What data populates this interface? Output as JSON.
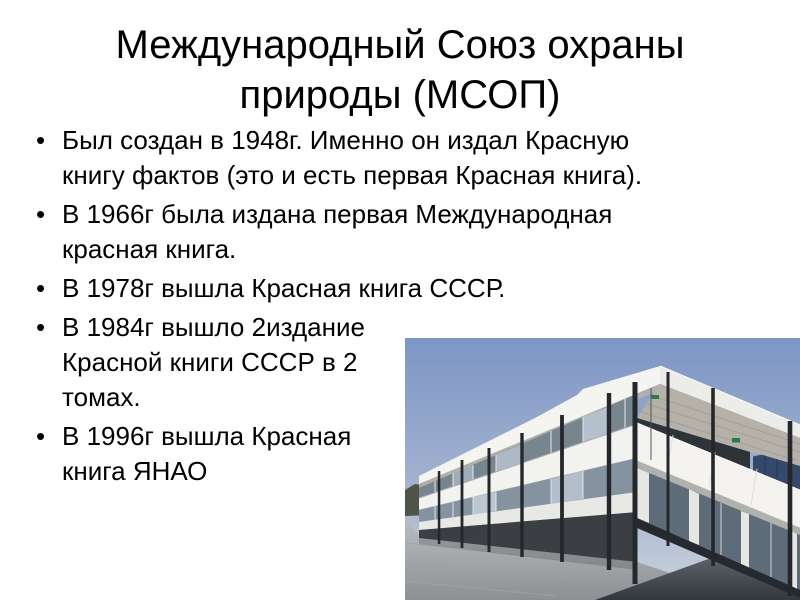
{
  "slide": {
    "bullet_char": "•",
    "text_color": "#000000",
    "title": {
      "lines": [
        "Международный Союз охраны",
        "природы (МСОП)"
      ]
    },
    "bullets": [
      {
        "lines": [
          "Был создан в 1948г. Именно он издал Красную",
          "книгу фактов (это и есть первая Красная книга)."
        ]
      },
      {
        "lines": [
          "В 1966г была издана первая Международная",
          "красная книга."
        ]
      },
      {
        "lines": [
          "В 1978г вышла Красная книга СССР."
        ]
      },
      {
        "lines": [
          "В 1984г вышло 2издание",
          "Красной книги СССР в 2",
          "томах."
        ]
      },
      {
        "lines": [
          "В 1996г вышла Красная",
          "книга ЯНАО"
        ]
      }
    ]
  },
  "photo": {
    "alt": "Corner view of a modern two-storey white office building with flat overhanging roof, dark slender columns, ribbon windows, paved forecourt and blue sky",
    "colors": {
      "sky_top": "#7d96c6",
      "sky_bottom": "#cdd4dd",
      "facade_white": "#f2f2ef",
      "soffit": "#b5b1a9",
      "glass": "#7b8995",
      "columns": "#24272b",
      "pavement": "#b0b3b5",
      "asphalt": "#3a3f45",
      "distant_building": "#35496b",
      "exit_sign_green": "#2e7b45"
    }
  }
}
